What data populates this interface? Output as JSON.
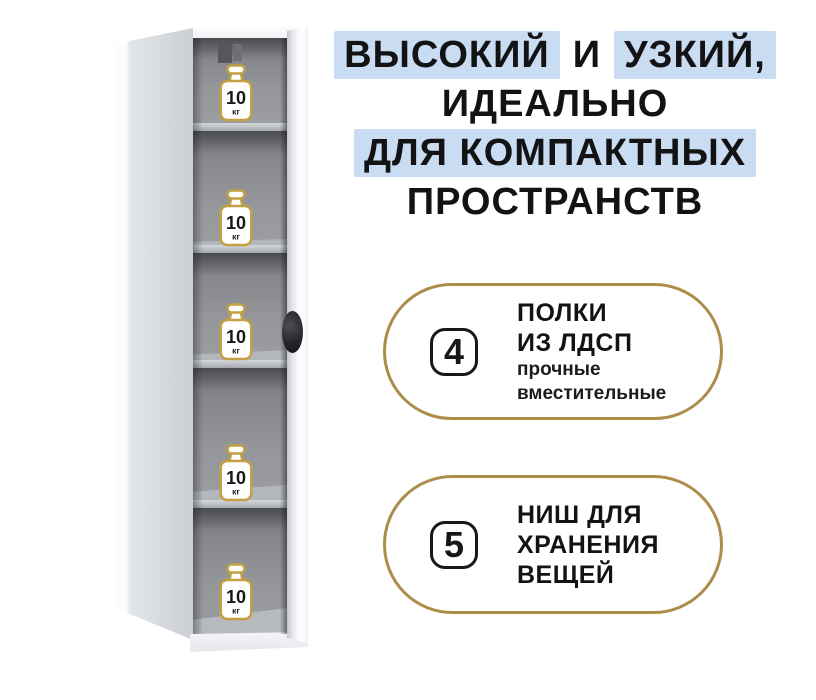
{
  "page": {
    "background": "#ffffff",
    "width": 816,
    "height": 700
  },
  "headline": {
    "highlight_color": "#c9dcf2",
    "text_color": "#131315",
    "lines": [
      {
        "segments": [
          {
            "text": "ВЫСОКИЙ",
            "highlighted": true
          },
          {
            "text": "И",
            "highlighted": false
          },
          {
            "text": "УЗКИЙ,",
            "highlighted": true
          }
        ]
      },
      {
        "segments": [
          {
            "text": "ИДЕАЛЬНО",
            "highlighted": false
          }
        ]
      },
      {
        "segments": [
          {
            "text": "ДЛЯ КОМПАКТНЫХ",
            "highlighted": true
          }
        ]
      },
      {
        "segments": [
          {
            "text": "ПРОСТРАНСТВ",
            "highlighted": false
          }
        ]
      }
    ]
  },
  "features": [
    {
      "number": "4",
      "title_lines": [
        "ПОЛКИ",
        "ИЗ ЛДСП"
      ],
      "subtitle_lines": [
        "прочные",
        "вместительные"
      ],
      "border_color": "#ac8e4a"
    },
    {
      "number": "5",
      "title_lines": [
        "НИШ ДЛЯ",
        "ХРАНЕНИЯ",
        "ВЕЩЕЙ"
      ],
      "subtitle_lines": [],
      "border_color": "#ac8e4a"
    }
  ],
  "cabinet": {
    "niche_count": 5,
    "door_handle_color": "#1c1c1f",
    "weight_icon_outline_color": "#c2a043",
    "weight_badges": [
      {
        "value": "10",
        "unit": "кг"
      },
      {
        "value": "10",
        "unit": "кг"
      },
      {
        "value": "10",
        "unit": "кг"
      },
      {
        "value": "10",
        "unit": "кг"
      },
      {
        "value": "10",
        "unit": "кг"
      }
    ]
  }
}
